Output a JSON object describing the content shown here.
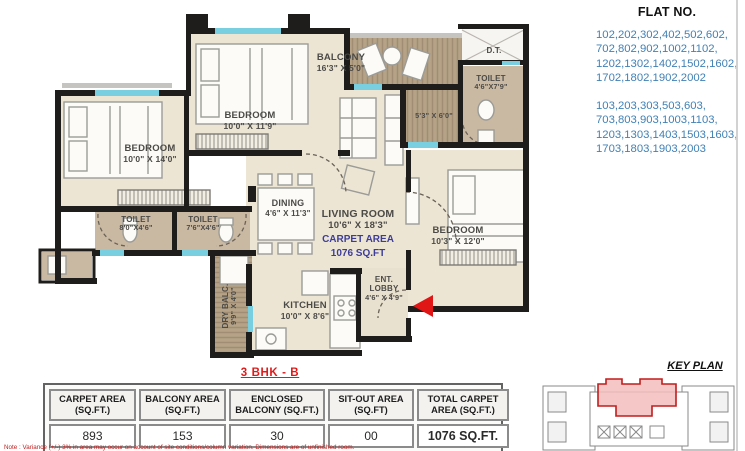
{
  "flat_no": {
    "title": "FLAT NO.",
    "group1": "102,202,302,402,502,602,\n702,802,902,1002,1102,\n1202,1302,1402,1502,1602,\n1702,1802,1902,2002",
    "group2": "103,203,303,503,603,\n703,803,903,1003,1103,\n1203,1303,1403,1503,1603,\n1703,1803,1903,2003"
  },
  "rooms": {
    "bedroom_left": {
      "name": "BEDROOM",
      "dims": "10'0\" X 14'0\""
    },
    "bedroom_middle": {
      "name": "BEDROOM",
      "dims": "10'0\" X 11'9\""
    },
    "bedroom_right": {
      "name": "BEDROOM",
      "dims": "10'3\" X 12'0\""
    },
    "balcony": {
      "name": "BALCONY",
      "dims": "16'3\" X 5'0\""
    },
    "duct": {
      "name": "D.T."
    },
    "toilet_top": {
      "name": "TOILET",
      "dims": "4'6\"X7'9\""
    },
    "enclosed_balcony": {
      "dims": "5'3\" X 6'0\""
    },
    "dining": {
      "name": "DINING",
      "dims": "4'6\" X 11'3\""
    },
    "living": {
      "name": "LIVING ROOM",
      "dims": "10'6\" X 18'3\""
    },
    "carpet": {
      "line1": "CARPET AREA",
      "line2": "1076 SQ.FT"
    },
    "toilet_1": {
      "name": "TOILET",
      "dims": "8'0\"X4'6\""
    },
    "toilet_2": {
      "name": "TOILET",
      "dims": "7'6\"X4'6\""
    },
    "dry_balcony": {
      "name": "DRY BALC.",
      "dims": "9'9\" X 4'0\""
    },
    "kitchen": {
      "name": "KITCHEN",
      "dims": "10'0\" X 8'6\""
    },
    "lobby": {
      "line1": "ENT.",
      "line2": "LOBBY",
      "dims": "4'6\" X 4'9\""
    }
  },
  "plan_label": "3 BHK - B",
  "table": {
    "headers": [
      "CARPET AREA\n(SQ.FT.)",
      "BALCONY AREA\n(SQ.FT.)",
      "ENCLOSED\nBALCONY (SQ.FT.)",
      "SIT-OUT AREA\n(SQ.FT)",
      "TOTAL CARPET\nAREA (SQ.FT.)"
    ],
    "values": [
      "893",
      "153",
      "30",
      "00",
      "1076 SQ.FT."
    ]
  },
  "key_plan": {
    "title": "KEY PLAN"
  },
  "note": "Note : Variance (+/-) 3% in area may occur on account of site conditions/column variation. Dimensions are of unfinished room.",
  "colors": {
    "flat_blue": "#4181b5",
    "carpet_blue": "#3d3d99",
    "accent_red": "#e01a1a",
    "wall": "#1f1d1b",
    "floor": "#ece5d4",
    "deck": "#b5a287",
    "window": "#79cfe0"
  }
}
